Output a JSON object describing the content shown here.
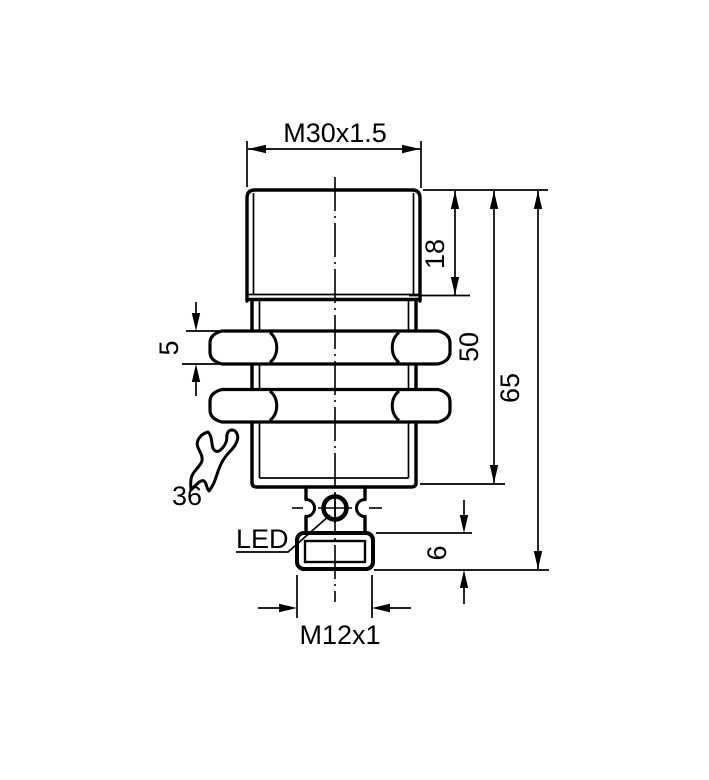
{
  "colors": {
    "line": "#000000",
    "background": "#ffffff"
  },
  "labels": {
    "thread_top": "M30x1.5",
    "head_length": "18",
    "barrel_length": "50",
    "total_length": "65",
    "nut_thickness": "5",
    "wrench_size": "36",
    "led": "LED",
    "connector_thread_length": "6",
    "connector_thread": "M12x1"
  },
  "icons": {
    "wrench": "wrench-icon",
    "led_indicator": "led-indicator-icon"
  }
}
